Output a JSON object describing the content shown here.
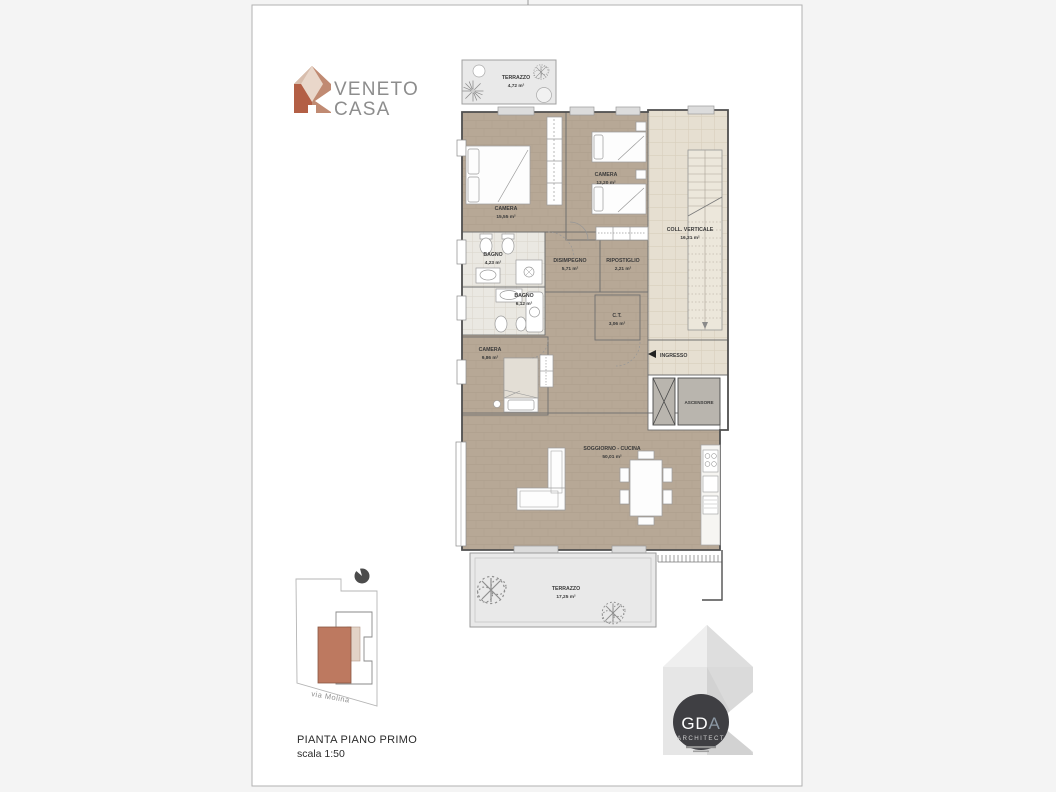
{
  "colors": {
    "background": "#f4f4f4",
    "sheet": "#ffffff",
    "wood_floor": "#b7a896",
    "tile_stairwell": "#e6dfd1",
    "tile_bathroom": "#eae8e2",
    "terrace": "#e9e9e9",
    "terracotta_accent": "#b35f45",
    "elevator_gray": "#b9b5ae",
    "brand_text_gray": "#8d8d8d"
  },
  "brand": {
    "name_line1": "VENETO",
    "name_line2": "CASA"
  },
  "plan": {
    "terrazzo_top": {
      "name": "TERRAZZO",
      "area": "4,72 m²"
    },
    "camera_grande": {
      "name": "CAMERA",
      "area": "15,55 m²"
    },
    "camera_doppia": {
      "name": "CAMERA",
      "area": "13,20 m²"
    },
    "coll_verticale": {
      "name": "COLL. VERTICALE",
      "area": "16,21 m²"
    },
    "bagno_piccolo": {
      "name": "BAGNO",
      "area": "4,23 m²"
    },
    "disimpegno": {
      "name": "DISIMPEGNO",
      "area": "5,71 m²"
    },
    "ripostiglio": {
      "name": "RIPOSTIGLIO",
      "area": "2,21 m²"
    },
    "bagno_grande": {
      "name": "BAGNO",
      "area": "6,12 m²"
    },
    "ct": {
      "name": "C.T.",
      "area": "3,06 m²"
    },
    "camera_singola": {
      "name": "CAMERA",
      "area": "9,86 m²"
    },
    "ingresso_label": "INGRESSO",
    "ascensore_label": "ASCENSORE",
    "soggiorno": {
      "name": "SOGGIORNO - CUCINA",
      "area": "50,01 m²"
    },
    "terrazzo_bottom": {
      "name": "TERRAZZO",
      "area": "17,25 m²"
    }
  },
  "site_plan": {
    "street_label": "via Molina"
  },
  "title_block": {
    "title": "PIANTA PIANO PRIMO",
    "scale": "scala 1:50"
  },
  "architect": {
    "initials_main": "GD",
    "initials_accent": "A",
    "subtitle": "ARCHITECT"
  }
}
